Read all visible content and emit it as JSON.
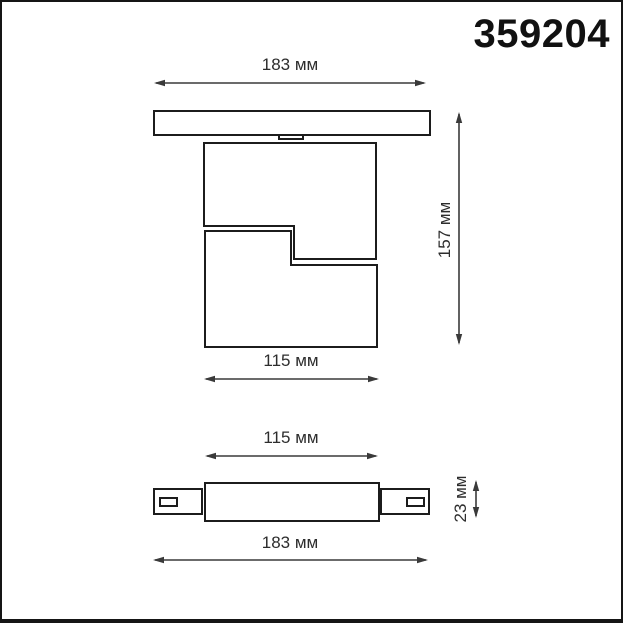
{
  "part_number": "359204",
  "labels": {
    "front_track_width": "183 мм",
    "front_height": "157 мм",
    "front_body_width": "115 мм",
    "top_body_width": "115 мм",
    "top_depth": "23 мм",
    "top_track_width": "183 мм"
  },
  "dimensions_mm": {
    "track_adapter_length": 183,
    "overall_height": 157,
    "body_width": 115,
    "body_depth": 23
  },
  "colors": {
    "outline": "#1c1c1c",
    "dimension_lines": "#3a3a3a",
    "text": "#2d2d2d",
    "background": "#ffffff",
    "frame_border": "#151515"
  }
}
